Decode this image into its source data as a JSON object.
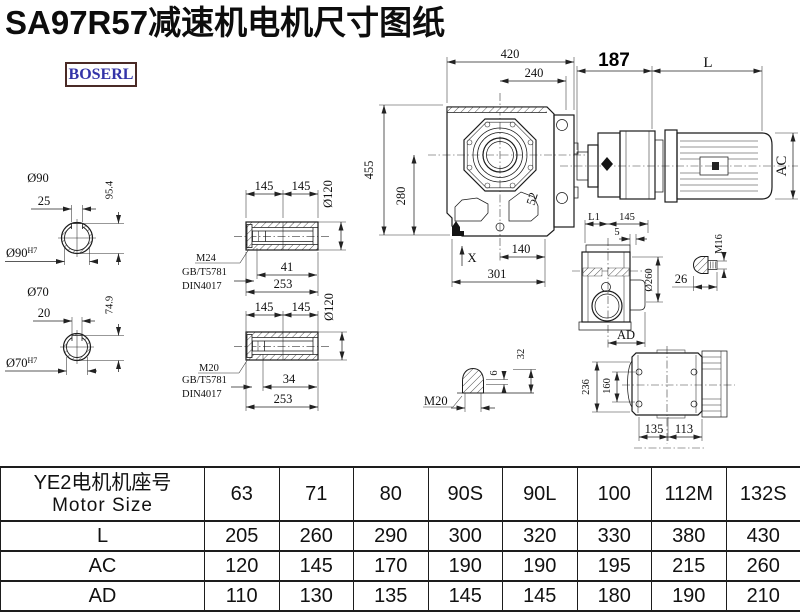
{
  "title": "SA97R57减速机电机尺寸图纸",
  "logo": "BOSERL",
  "dims": {
    "front": {
      "w": "420",
      "w2": "240",
      "h": "455",
      "h2": "280",
      "d52": "52",
      "d140": "140",
      "d301": "301",
      "x": "X"
    },
    "motor": {
      "d187": "187",
      "L": "L",
      "AC": "AC"
    },
    "shaft90": {
      "dia": "Ø90",
      "key": "25",
      "kh": "95.4",
      "bore": "Ø90",
      "tol": "H7"
    },
    "shaft70": {
      "dia": "Ø70",
      "key": "20",
      "kh": "74.9",
      "bore": "Ø70",
      "tol": "H7"
    },
    "hs1": {
      "a": "145",
      "b": "145",
      "dia": "Ø120",
      "bolt": "M24",
      "std1": "GB/T5781",
      "std2": "DIN4017",
      "t": "41",
      "len": "253"
    },
    "hs2": {
      "a": "145",
      "b": "145",
      "dia": "Ø120",
      "bolt": "M20",
      "std1": "GB/T5781",
      "std2": "DIN4017",
      "t": "34",
      "len": "253"
    },
    "side": {
      "l1": "L1",
      "a": "145",
      "b": "5",
      "dia": "Ø260",
      "ad": "AD"
    },
    "m16": {
      "label": "M16",
      "len": "26"
    },
    "plug": {
      "label": "M20",
      "a": "6",
      "b": "32"
    },
    "bottom": {
      "h": "236",
      "inner": "160",
      "a": "135",
      "b": "113"
    }
  },
  "table": {
    "header_cn": "YE2电机机座号",
    "header_en": "Motor Size",
    "columns": [
      "63",
      "71",
      "80",
      "90S",
      "90L",
      "100",
      "112M",
      "132S"
    ],
    "rows": [
      {
        "label": "L",
        "values": [
          "205",
          "260",
          "290",
          "300",
          "320",
          "330",
          "380",
          "430"
        ]
      },
      {
        "label": "AC",
        "values": [
          "120",
          "145",
          "170",
          "190",
          "190",
          "195",
          "215",
          "260"
        ]
      },
      {
        "label": "AD",
        "values": [
          "110",
          "130",
          "135",
          "145",
          "145",
          "180",
          "190",
          "210"
        ]
      }
    ]
  }
}
